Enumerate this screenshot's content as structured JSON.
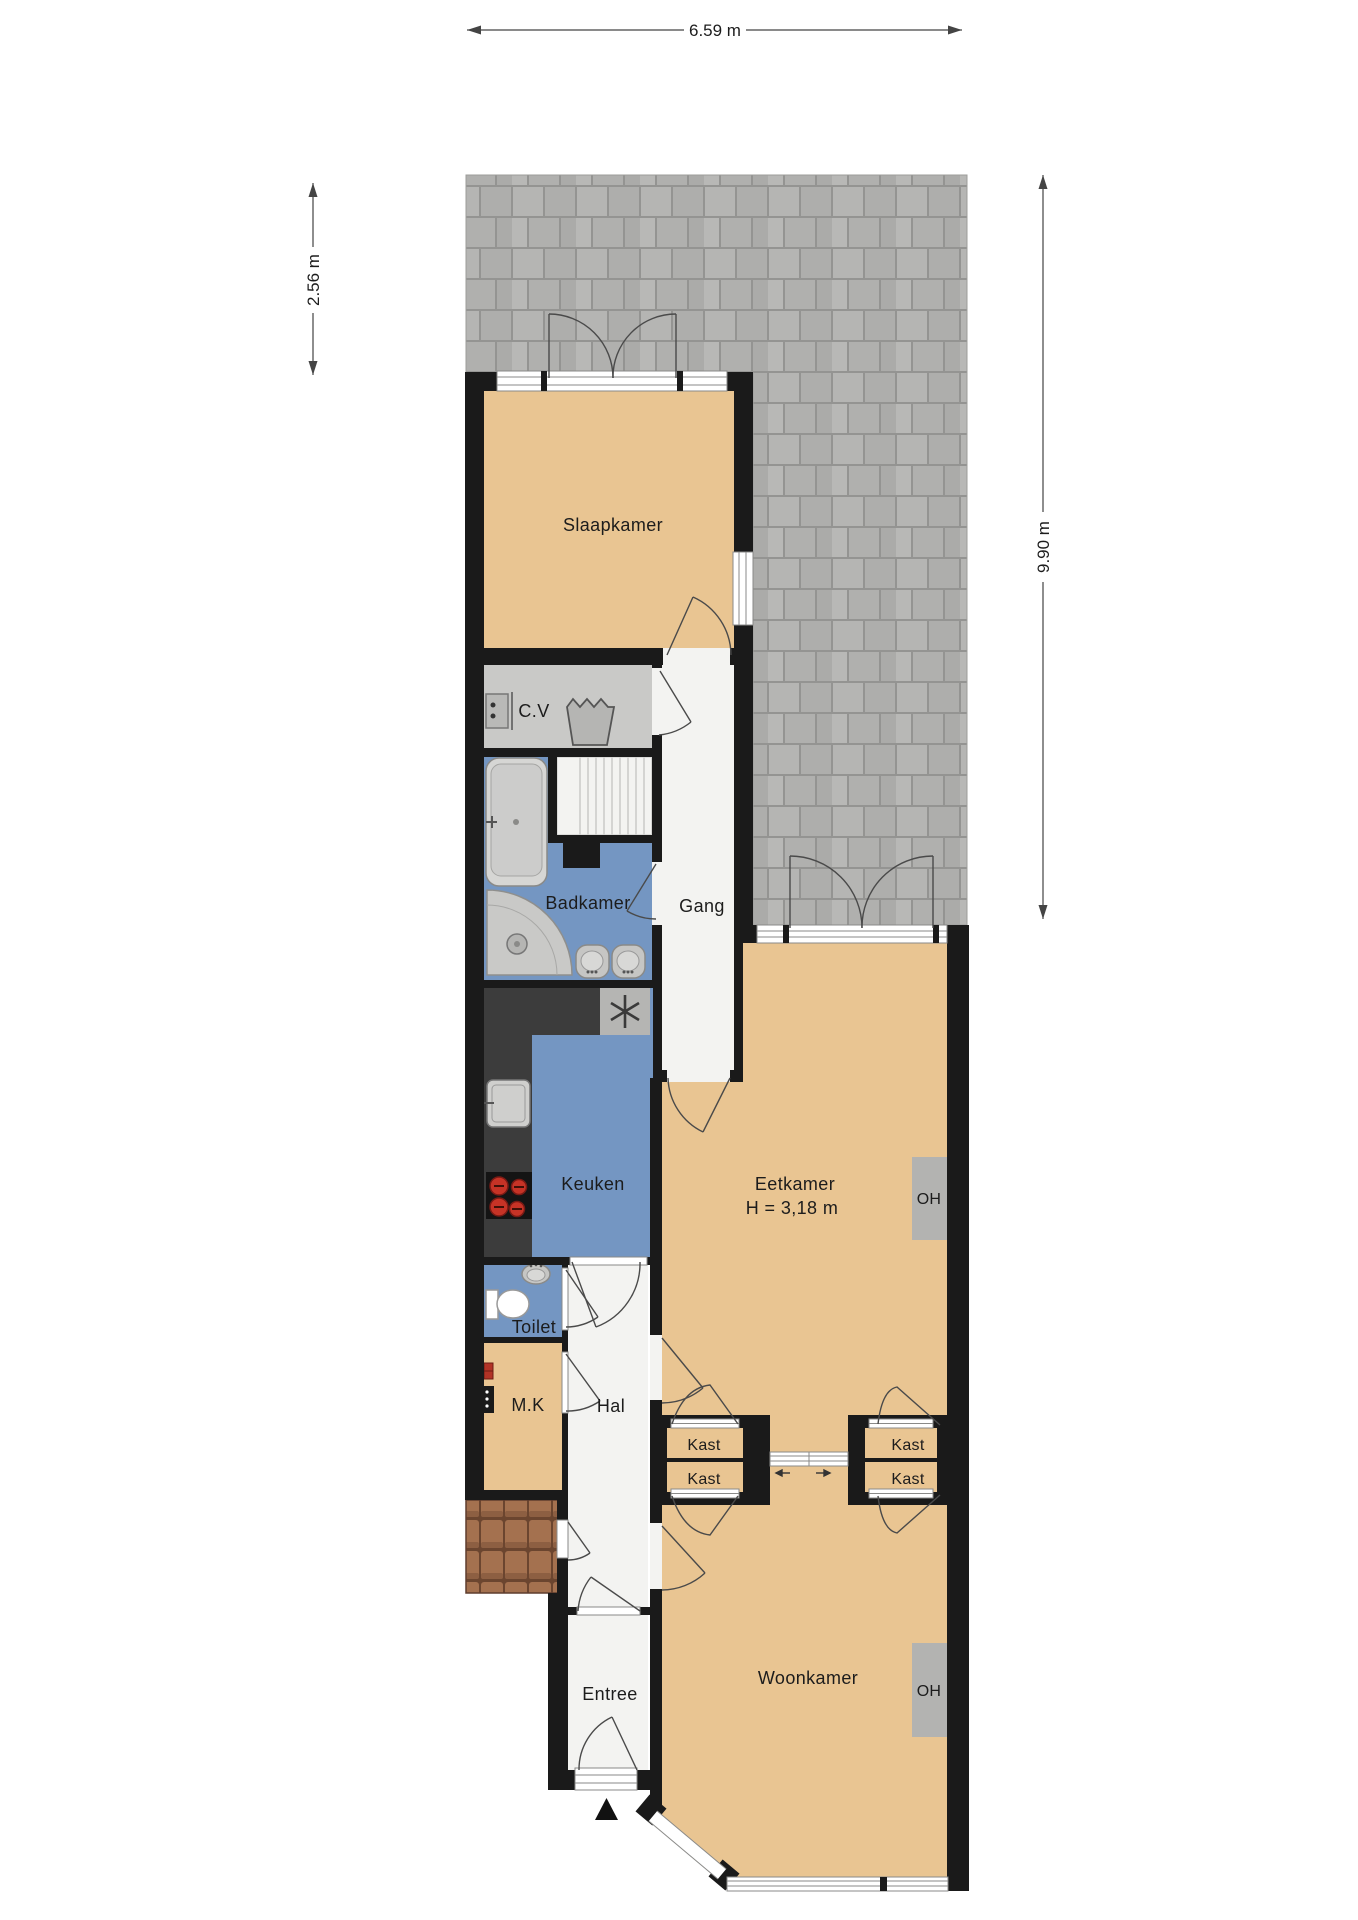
{
  "dimensions": {
    "top": "6.59 m",
    "left": "2.56 m",
    "right": "9.90 m"
  },
  "rooms": {
    "slaapkamer": {
      "label": "Slaapkamer"
    },
    "cv": {
      "label": "C.V"
    },
    "gang": {
      "label": "Gang"
    },
    "badkamer": {
      "label": "Badkamer"
    },
    "keuken": {
      "label": "Keuken"
    },
    "eetkamer": {
      "label": "Eetkamer",
      "height_note": "H = 3,18 m"
    },
    "toilet": {
      "label": "Toilet"
    },
    "mk": {
      "label": "M.K"
    },
    "hal": {
      "label": "Hal"
    },
    "entree": {
      "label": "Entree"
    },
    "woonkamer": {
      "label": "Woonkamer"
    },
    "kast": {
      "label": "Kast"
    },
    "oh": {
      "label": "OH"
    }
  },
  "colors": {
    "wall": "#1a1a1a",
    "room_tan": "#e9c592",
    "room_blue": "#7496c2",
    "room_gray": "#c9c9c7",
    "corridor": "#f3f3f1",
    "counter_dark": "#3c3c3c",
    "oh_gray": "#b3b3b1",
    "paving": "#b2b2b0",
    "paving_gap": "#949492",
    "tile": "#a4714f",
    "tile_dark": "#6b452f",
    "burner_red": "#c63326",
    "fixture": "#cfcfcd",
    "arc_line": "#4a4a4a",
    "dim_line": "#444444",
    "text": "#1c1c1c"
  }
}
